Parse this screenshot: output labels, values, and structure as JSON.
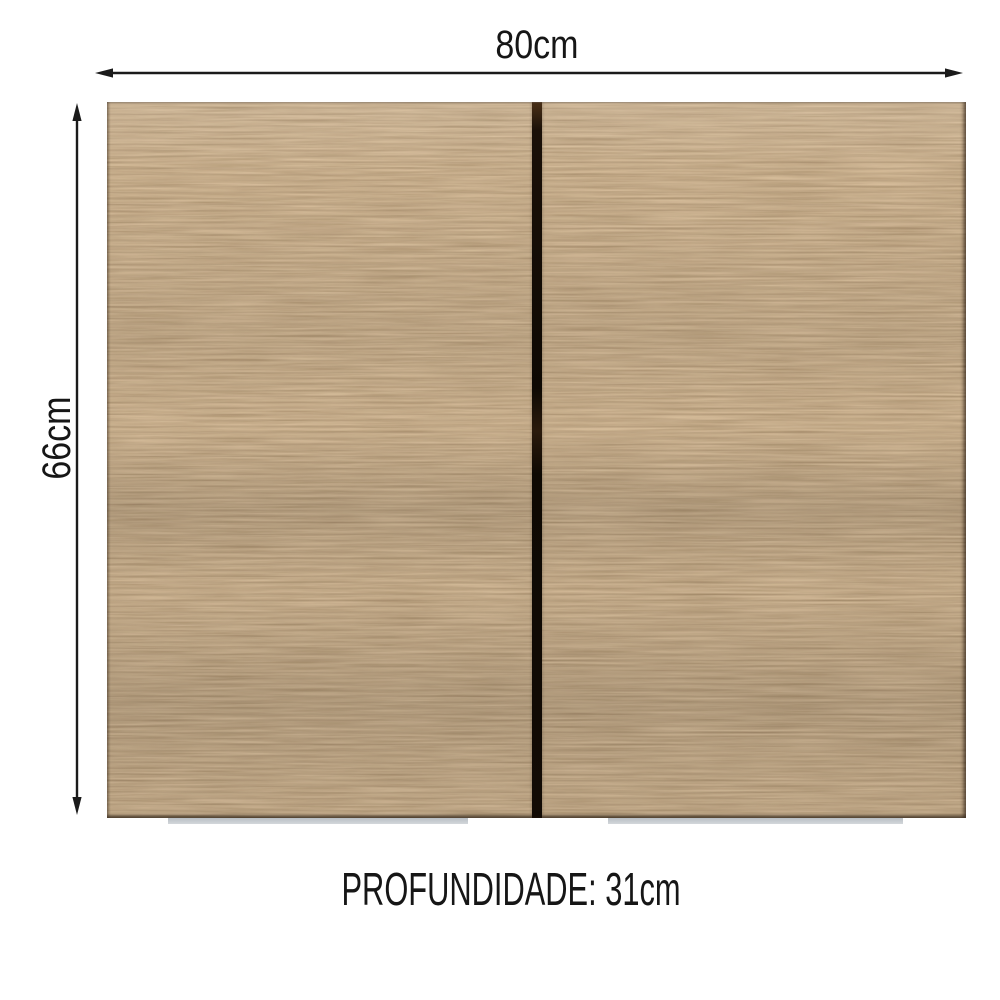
{
  "diagram": {
    "width_dimension": {
      "label": "80cm"
    },
    "height_dimension": {
      "label": "66cm"
    },
    "depth_dimension": {
      "label": "PROFUNDIDADE: 31cm"
    }
  },
  "cabinet": {
    "door_count": 2,
    "colors": {
      "wood_base": "#97774e",
      "wood_grain_dark": "#6b4c2e",
      "wood_grain_light": "#b28b5d",
      "door_gap": "#120c06",
      "bottom_trim": "#c7cbd0",
      "dimension_lines": "#1b1b1b",
      "text": "#161616",
      "background": "#ffffff"
    }
  }
}
